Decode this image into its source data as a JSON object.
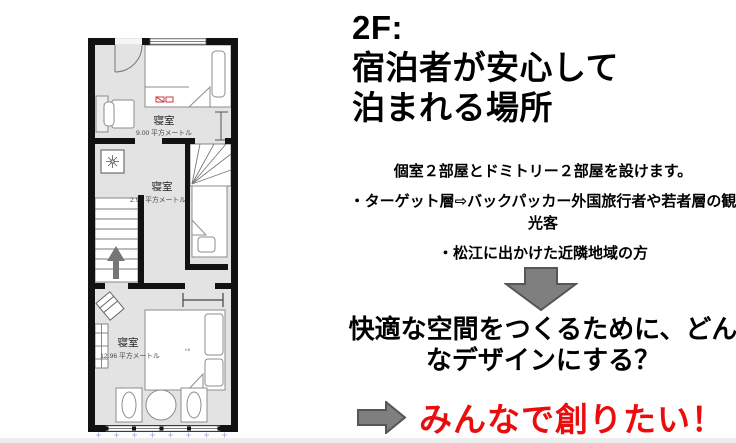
{
  "slide": {
    "title_lines": [
      "2F:",
      "宿泊者が安心して",
      "泊まれる場所"
    ],
    "intro": "個室２部屋とドミトリー２部屋を設けます。",
    "target_line1": "・ターゲット層⇨バックパッカー外国旅行者や若者層の観",
    "target_line2": "光客",
    "neighbors": "・松江に出かけた近隣地域の方",
    "question_line1": "快適な空間をつくるために、どん",
    "question_line2": "なデザインにする？",
    "cta": "みんなで創りたい！"
  },
  "floorplan": {
    "rooms": [
      {
        "name": "寝室",
        "area": "9.00 平方メートル"
      },
      {
        "name": "寝室",
        "area": "2.96 平方メートル"
      },
      {
        "name": "寝室",
        "area": "12.96 平方メートル"
      }
    ],
    "bed_marks": {
      "room1": "CXO",
      "room3": "KB"
    }
  },
  "colors": {
    "cta_red": "#e90d0d",
    "arrow_fill": "#7f7f7f",
    "arrow_stroke": "#565656",
    "floor": "#e3e3e3",
    "wall": "#121212"
  }
}
